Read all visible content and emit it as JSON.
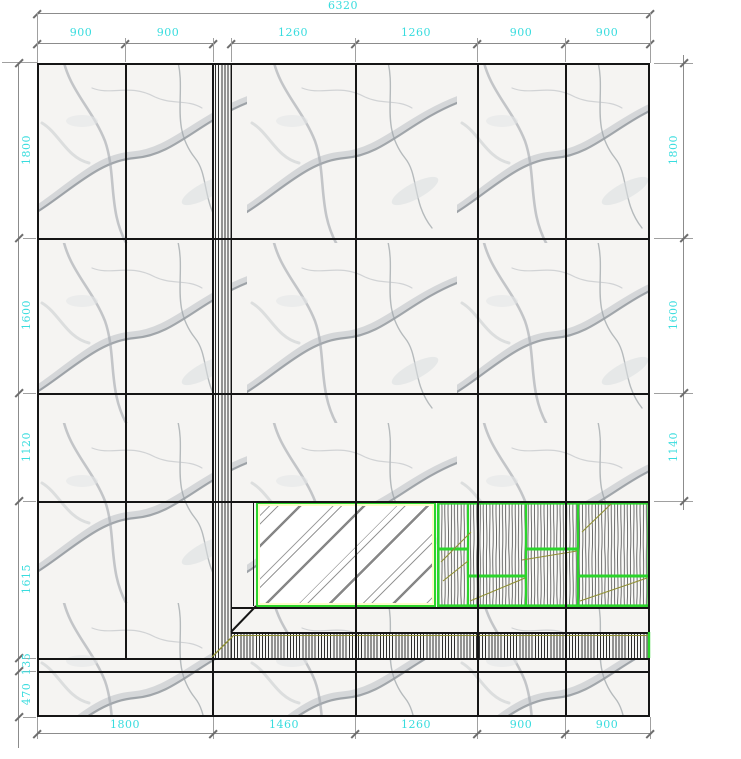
{
  "dimensions": {
    "top_total": "6320",
    "top_segments": [
      "900",
      "900",
      "1260",
      "1260",
      "900",
      "900"
    ],
    "left": [
      "1800",
      "1600",
      "1120",
      "1615",
      "135",
      "470"
    ],
    "right": [
      "1800",
      "1600",
      "1140"
    ],
    "bottom": [
      "1800",
      "1460",
      "1260",
      "900",
      "900"
    ]
  },
  "colors": {
    "dimension_text": "#38dcde",
    "dimension_line": "#8c8c8c",
    "joint_line": "#151515",
    "frame_green": "#2bd52b",
    "swing_olive": "#8f8f33",
    "frame_inner_yellow": "#fdfdc9"
  }
}
